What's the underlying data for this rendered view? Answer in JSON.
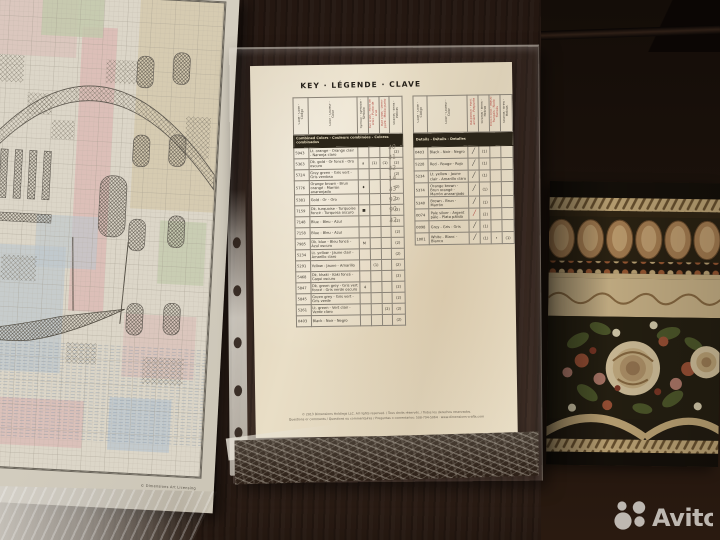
{
  "watermark": {
    "brand": "Avito"
  },
  "chart_sheet": {
    "copyright": "© Dimensions Art Licensing"
  },
  "key_page": {
    "title": "KEY · LÉGENDE · CLAVE",
    "combined": {
      "section_title": "Combined Colors - Couleurs combinées - Colores combinados",
      "column_headers": [
        {
          "label": "Code - Code - Código",
          "tone": ""
        },
        {
          "label": "Color - Couleur - Color",
          "tone": ""
        },
        {
          "label": "Symbol - Symbole - Símbolo",
          "tone": ""
        },
        {
          "label": "Full cross - Point de croix - Punto de cruz",
          "tone": "red"
        },
        {
          "label": "Half cross - Demi-point - Medio punto",
          "tone": "red"
        },
        {
          "label": "Strands - Brins - Hebras",
          "tone": ""
        }
      ],
      "rows": [
        {
          "code": "5943",
          "name": "Lt. orange - Orange clair - Naranja claro",
          "sym": "",
          "c1": "",
          "c2": "",
          "c3": "(2)"
        },
        {
          "code": "5363",
          "name": "Dk. gold - Or foncé - Oro oscuro",
          "sym": "a",
          "c1": "(1)",
          "c2": "(1)",
          "c3": "(2)"
        },
        {
          "code": "5724",
          "name": "Grey green - Gris vert - Gris verdoso",
          "sym": "",
          "c1": "",
          "c2": "",
          "c3": "(2)"
        },
        {
          "code": "5776",
          "name": "Orange brown - Brun orangé - Marrón anaranjado",
          "sym": "♦",
          "c1": "",
          "c2": "",
          "c3": "(2)"
        },
        {
          "code": "5381",
          "name": "Gold - Or - Oro",
          "sym": "",
          "c1": "",
          "c2": "",
          "c3": "(2)"
        },
        {
          "code": "7159",
          "name": "Dk. turquoise - Turquoise foncé - Turquesa oscuro",
          "sym": "■",
          "c1": "",
          "c2": "",
          "c3": "(2)"
        },
        {
          "code": "7148",
          "name": "Blue - Bleu - Azul",
          "sym": "",
          "c1": "",
          "c2": "",
          "c3": "(2)"
        },
        {
          "code": "7158",
          "name": "Blue - Bleu - Azul",
          "sym": "",
          "c1": "",
          "c2": "",
          "c3": "(2)"
        },
        {
          "code": "7985",
          "name": "Dk. blue - Bleu foncé - Azul oscuro",
          "sym": "M",
          "c1": "",
          "c2": "",
          "c3": "(2)"
        },
        {
          "code": "5234",
          "name": "Lt. yellow - Jaune clair - Amarillo claro",
          "sym": "",
          "c1": "",
          "c2": "",
          "c3": "(2)"
        },
        {
          "code": "5291",
          "name": "Yellow - Jaune - Amarillo",
          "sym": "",
          "c1": "(1)",
          "c2": "",
          "c3": "(2)"
        },
        {
          "code": "5468",
          "name": "Dk. khaki - Kaki foncé - Caqui oscuro",
          "sym": "",
          "c1": "",
          "c2": "",
          "c3": "(2)"
        },
        {
          "code": "5847",
          "name": "Dk. green grey - Gris vert foncé - Gris verde oscuro",
          "sym": "4",
          "c1": "",
          "c2": "",
          "c3": "(2)"
        },
        {
          "code": "5845",
          "name": "Green grey - Gris vert - Gris verde",
          "sym": "",
          "c1": "",
          "c2": "",
          "c3": "(2)"
        },
        {
          "code": "5261",
          "name": "Lt. green - Vert clair - Verde claro",
          "sym": "",
          "c1": "",
          "c2": "(2)",
          "c3": "(2)"
        },
        {
          "code": "0403",
          "name": "Black - Noir - Negro",
          "sym": "",
          "c1": "",
          "c2": "",
          "c3": "(2)"
        }
      ]
    },
    "details": {
      "section_title": "Details - Détails - Detalles",
      "column_headers": [
        {
          "label": "Code - Code - Código",
          "tone": ""
        },
        {
          "label": "Color - Couleur - Color",
          "tone": ""
        },
        {
          "label": "Backstitch - Point arrière - Pespunte",
          "tone": "red"
        },
        {
          "label": "Strands - Brins - Hebras",
          "tone": ""
        },
        {
          "label": "French knot - Nœud français - Nudo francés",
          "tone": "red"
        },
        {
          "label": "Strands - Brins - Hebras",
          "tone": ""
        }
      ],
      "rows": [
        {
          "code": "0403",
          "name": "Black - Noir - Negro",
          "stroke": "dark",
          "c1": "(1)",
          "knot": "",
          "c2": ""
        },
        {
          "code": "5228",
          "name": "Red - Rouge - Rojo",
          "stroke": "dark",
          "c1": "(1)",
          "knot": "",
          "c2": ""
        },
        {
          "code": "5234",
          "name": "Lt. yellow - Jaune clair - Amarillo claro",
          "stroke": "dark",
          "c1": "(1)",
          "knot": "",
          "c2": ""
        },
        {
          "code": "5374",
          "name": "Orange brown - Brun orangé - Marrón anaranjado",
          "stroke": "dark",
          "c1": "(1)",
          "knot": "",
          "c2": ""
        },
        {
          "code": "5240",
          "name": "Brown - Brun - Marrón",
          "stroke": "dark",
          "c1": "(1)",
          "knot": "",
          "c2": ""
        },
        {
          "code": "0074",
          "name": "Pale silver - Argent pâle - Plata pálida",
          "stroke": "red",
          "c1": "(2)",
          "knot": "",
          "c2": ""
        },
        {
          "code": "0098",
          "name": "Grey - Gris - Gris",
          "stroke": "dark",
          "c1": "(1)",
          "knot": "",
          "c2": ""
        },
        {
          "code": "1001",
          "name": "White - Blanc - Blanco",
          "stroke": "dark",
          "c1": "(1)",
          "knot": "•",
          "c2": "(1)"
        }
      ]
    },
    "handwritten_numbers": [
      "40",
      "41",
      "42",
      "14",
      "43",
      "92",
      "90",
      "42"
    ],
    "footer_line1": "© 2013 Dimensions Holdings LLC. All rights reserved. / Tous droits réservés. / Todos los derechos reservados.",
    "footer_line2": "Questions or comments / Questions ou commentaires / Preguntas o comentarios: 508-794-5064 · www.dimensions-crafts.com"
  }
}
